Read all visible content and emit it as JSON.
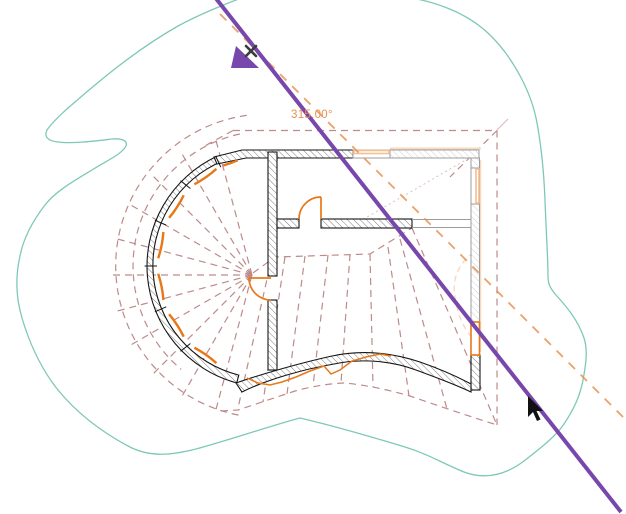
{
  "viewport": {
    "type": "cad-plan-view",
    "angle_indicator": "315.00°"
  },
  "colors": {
    "canvasBg": "#ffffff",
    "purple": "#7747AC",
    "teal": "#7FC8B8",
    "roofDash": "#BE8A8A",
    "ghostPink": "#E0BDBD",
    "wallDark": "#151515",
    "hatchDark": "#6E6E6E",
    "wallGray": "#9C9C9C",
    "hatchGray": "#C9C9C9",
    "orange": "#E87817",
    "peach": "#F6BE92",
    "peachLight": "#F8D9BE",
    "labelOrange": "#EA9150",
    "cursorBlack": "#111111",
    "xMark": "#3C3C3C"
  },
  "elements": {
    "site_contour": "topography contour",
    "section_line": "purple reference/section line",
    "angle_guide": "45-degree angle guide line",
    "roof_overlay": "dashed conical and hip roof lines",
    "walls": "hatched floor-plan walls",
    "doors": "orange door swings",
    "windows": "wall window openings",
    "snap_x_marker": "snap x marker",
    "pointer": "mouse cursor arrow"
  }
}
